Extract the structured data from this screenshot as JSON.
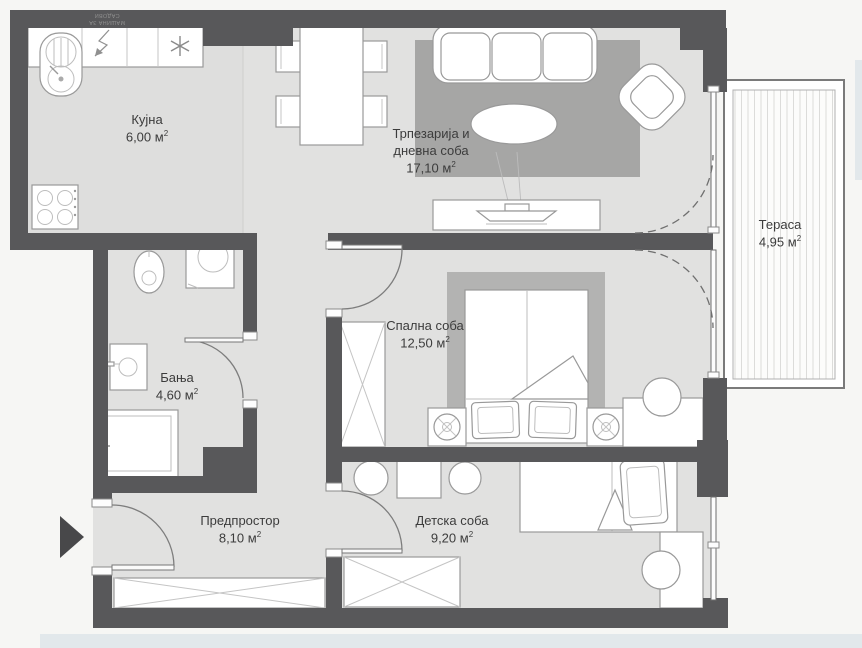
{
  "meta": {
    "plan_title": "Floor plan",
    "area_superscript": "2"
  },
  "colors": {
    "wall": "#58585a",
    "floor": "#e1e1e0",
    "floor_kitchen": "#dededd",
    "rug": "#a6a6a5",
    "rug_bedroom": "#b3b3b2",
    "outline": "#999999",
    "background": "#f6f6f4",
    "terrace_stripe": "#dcdcda",
    "label_text": "#3c3c3c",
    "accent_strip": "#e2e8eb"
  },
  "rooms": {
    "kitchen": {
      "name": "Кујна",
      "area": "6,00 м"
    },
    "living": {
      "name_line1": "Трпезарија и",
      "name_line2": "дневна соба",
      "area": "17,10 м"
    },
    "terrace": {
      "name": "Тераса",
      "area": "4,95 м"
    },
    "bedroom": {
      "name": "Спална соба",
      "area": "12,50 м"
    },
    "bathroom": {
      "name": "Бања",
      "area": "4,60 м"
    },
    "hall": {
      "name": "Предпростор",
      "area": "8,10 м"
    },
    "kids": {
      "name": "Детска соба",
      "area": "9,20 м"
    }
  },
  "annotations": {
    "dishwasher_line1": "МАШИНА ЗА",
    "dishwasher_line2": "САДОВИ"
  }
}
